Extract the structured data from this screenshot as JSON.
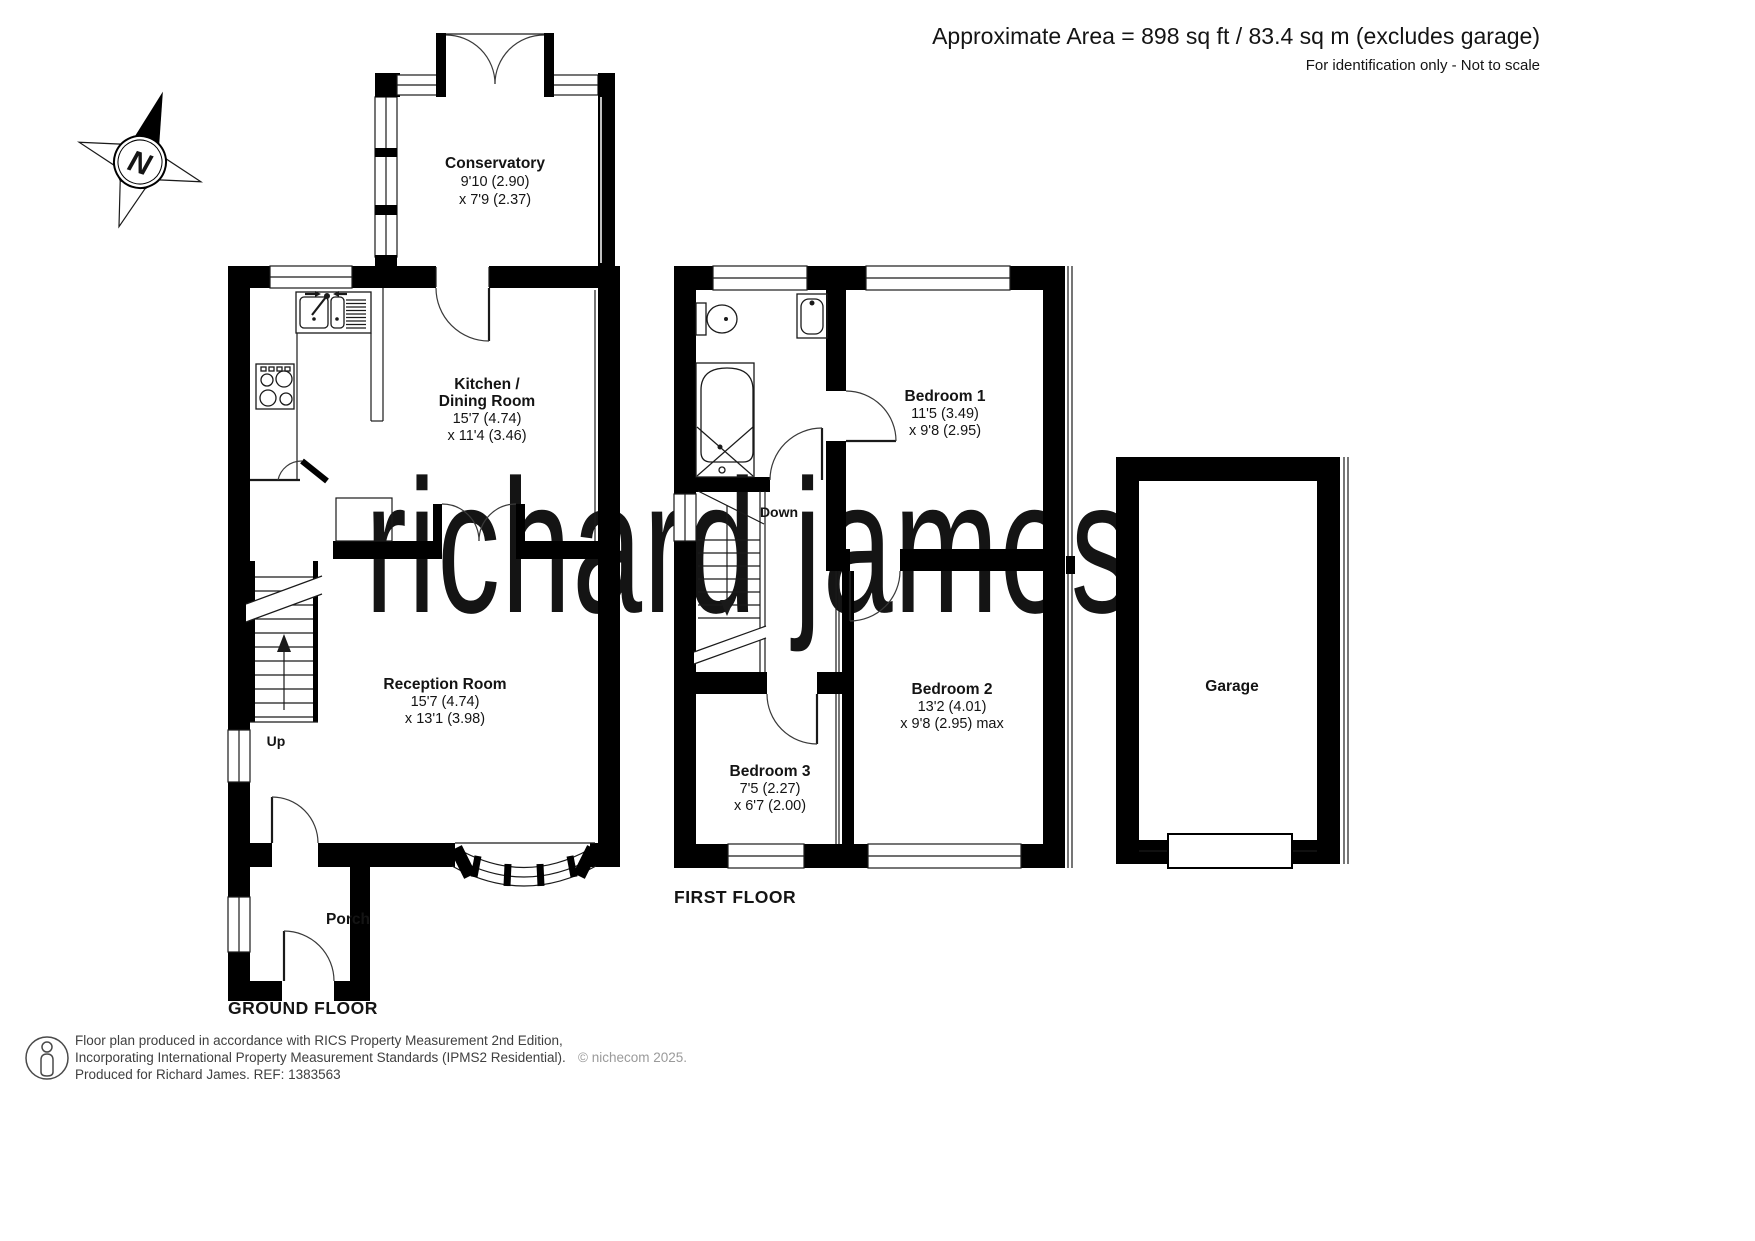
{
  "header": {
    "area_line": "Approximate Area = 898 sq ft / 83.4 sq m (excludes garage)",
    "note_line": "For identification only - Not to scale"
  },
  "compass": {
    "north_label": "N"
  },
  "watermark": {
    "text": "richard james"
  },
  "floors": {
    "ground_label": "GROUND FLOOR",
    "first_label": "FIRST FLOOR"
  },
  "rooms": {
    "conservatory": {
      "name": "Conservatory",
      "dim1": "9'10 (2.90)",
      "dim2": "x 7'9 (2.37)"
    },
    "kitchen": {
      "name_line1": "Kitchen /",
      "name_line2": "Dining Room",
      "dim1": "15'7 (4.74)",
      "dim2": "x 11'4 (3.46)"
    },
    "reception": {
      "name": "Reception Room",
      "dim1": "15'7 (4.74)",
      "dim2": "x 13'1 (3.98)"
    },
    "porch": {
      "name": "Porch"
    },
    "bedroom1": {
      "name": "Bedroom 1",
      "dim1": "11'5 (3.49)",
      "dim2": "x 9'8 (2.95)"
    },
    "bedroom2": {
      "name": "Bedroom 2",
      "dim1": "13'2 (4.01)",
      "dim2": "x 9'8 (2.95) max"
    },
    "bedroom3": {
      "name": "Bedroom 3",
      "dim1": "7'5 (2.27)",
      "dim2": "x 6'7 (2.00)"
    },
    "garage": {
      "name": "Garage"
    }
  },
  "stairs": {
    "up_label": "Up",
    "down_label": "Down"
  },
  "footer": {
    "line1": "Floor plan produced in accordance with RICS Property Measurement 2nd Edition,",
    "line2": "Incorporating International Property Measurement Standards (IPMS2 Residential).",
    "copyright": "© nichecom 2025.",
    "line3": "Produced for Richard James.   REF:  1383563"
  },
  "colors": {
    "wall": "#000000",
    "watermark": "#f1e2c3"
  }
}
